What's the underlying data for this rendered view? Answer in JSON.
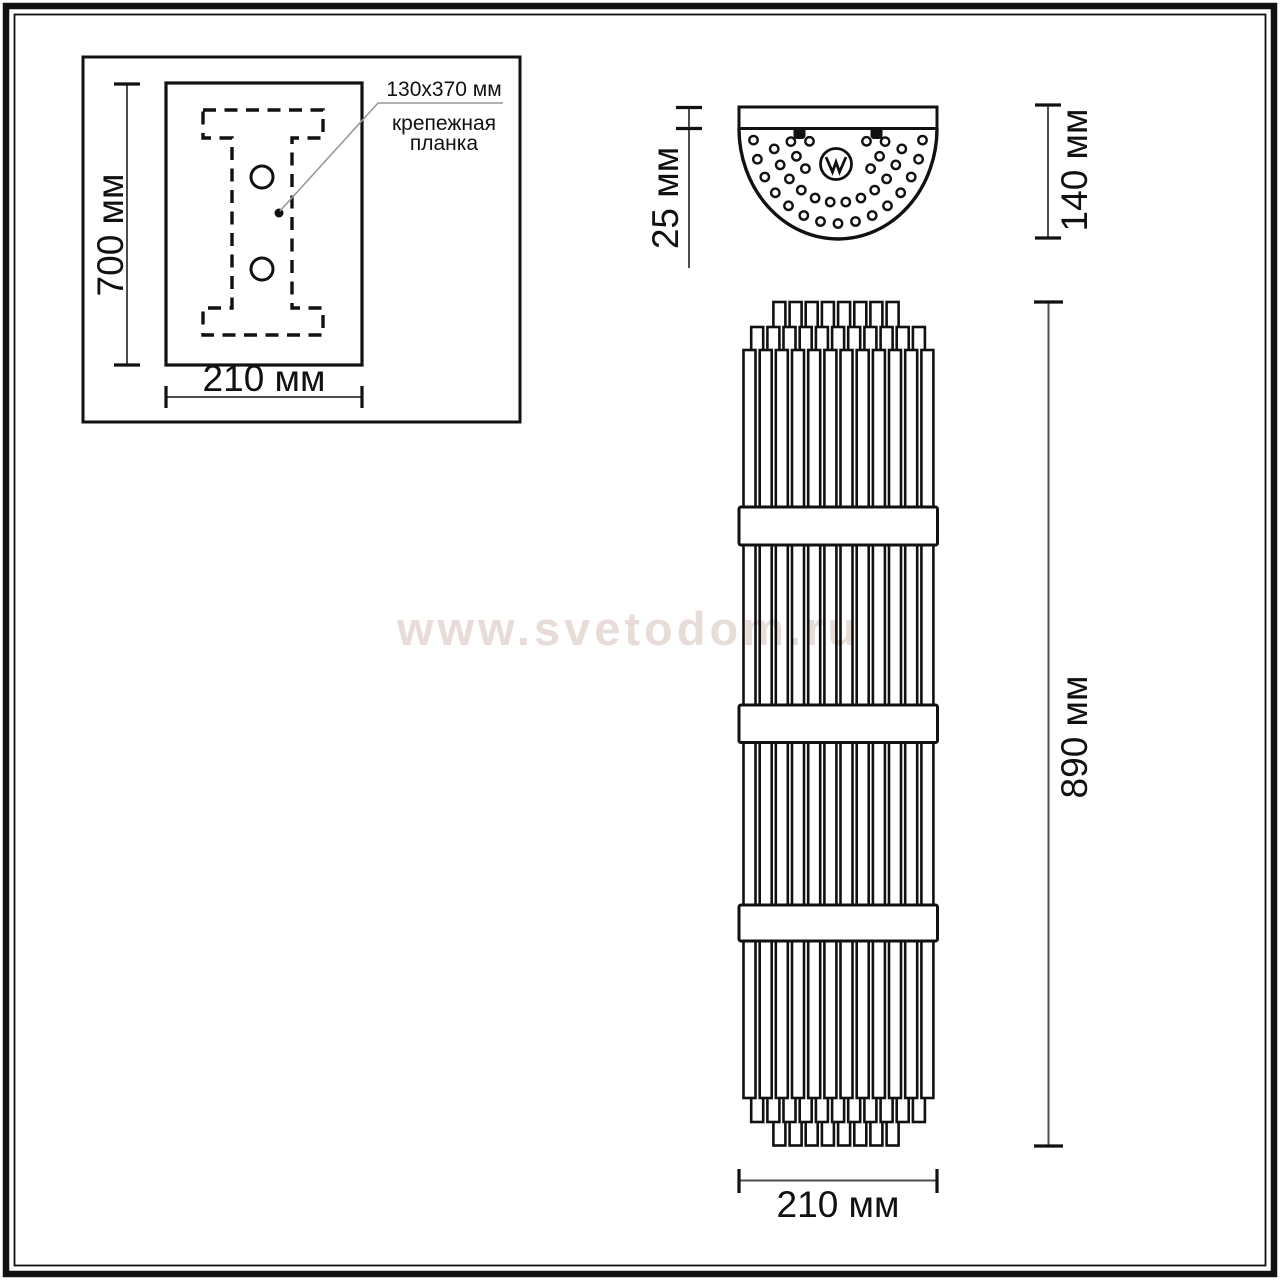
{
  "watermark": "www.svetodom.ru",
  "colors": {
    "line": "#111111",
    "dimension_line": "#4d4d4d",
    "leader_line": "#999999",
    "watermark": "#e7dcd8"
  },
  "mounting_panel": {
    "height_label": "700 мм",
    "width_label": "210 мм",
    "callout_size": "130x370 мм",
    "callout_name_line1": "крепежная",
    "callout_name_line2": "планка"
  },
  "top_view": {
    "plate_depth_label": "25 мм",
    "total_depth_label": "140 мм"
  },
  "front_view": {
    "height_label": "890 мм",
    "width_label": "210 мм"
  }
}
